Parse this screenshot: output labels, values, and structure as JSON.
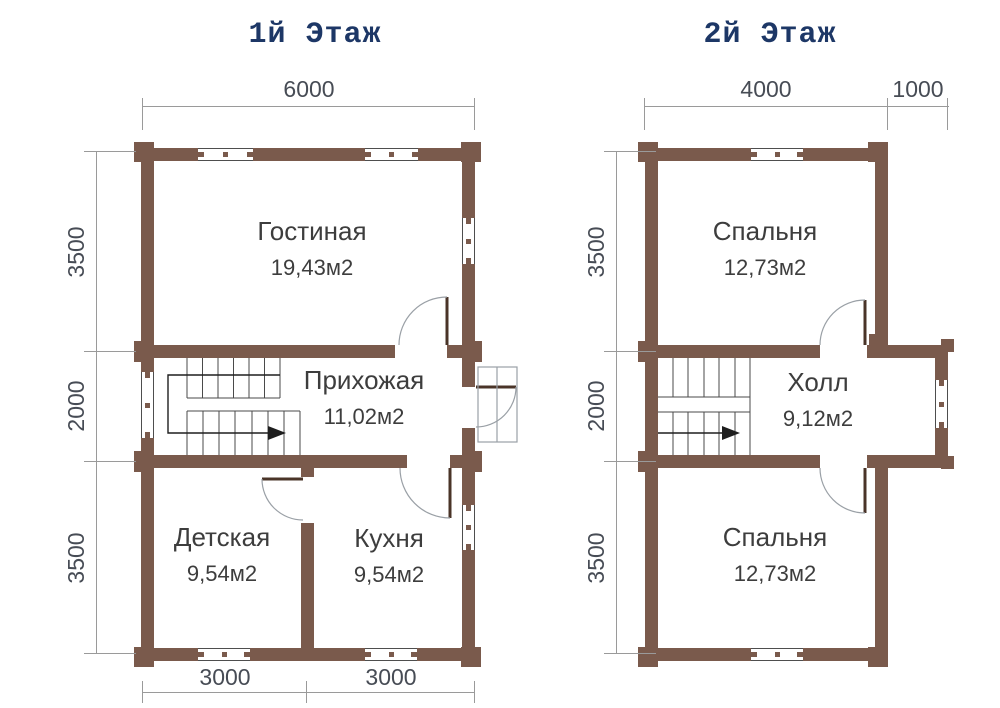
{
  "titles": {
    "floor1": "1й Этаж",
    "floor2": "2й Этаж"
  },
  "floor1": {
    "rooms": [
      {
        "name": "Гостиная",
        "area": "19,43м2"
      },
      {
        "name": "Прихожая",
        "area": "11,02м2"
      },
      {
        "name": "Детская",
        "area": "9,54м2"
      },
      {
        "name": "Кухня",
        "area": "9,54м2"
      }
    ],
    "dims": {
      "top": "6000",
      "left": [
        "3500",
        "2000",
        "3500"
      ],
      "bottom": [
        "3000",
        "3000"
      ]
    }
  },
  "floor2": {
    "rooms": [
      {
        "name": "Спальня",
        "area": "12,73м2"
      },
      {
        "name": "Холл",
        "area": "9,12м2"
      },
      {
        "name": "Спальня",
        "area": "12,73м2"
      }
    ],
    "dims": {
      "top": [
        "4000",
        "1000"
      ],
      "left": [
        "3500",
        "2000",
        "3500"
      ]
    }
  },
  "colors": {
    "wall": "#7a5a4c",
    "wall_edge": "#5e4437",
    "title": "#1d3766",
    "label": "#3d3d3d",
    "dim": "#474c55",
    "line": "#9a9a9a",
    "leaf": "#4a3428",
    "stair": "#4a4a4a",
    "walk": "#1e1e1e"
  }
}
